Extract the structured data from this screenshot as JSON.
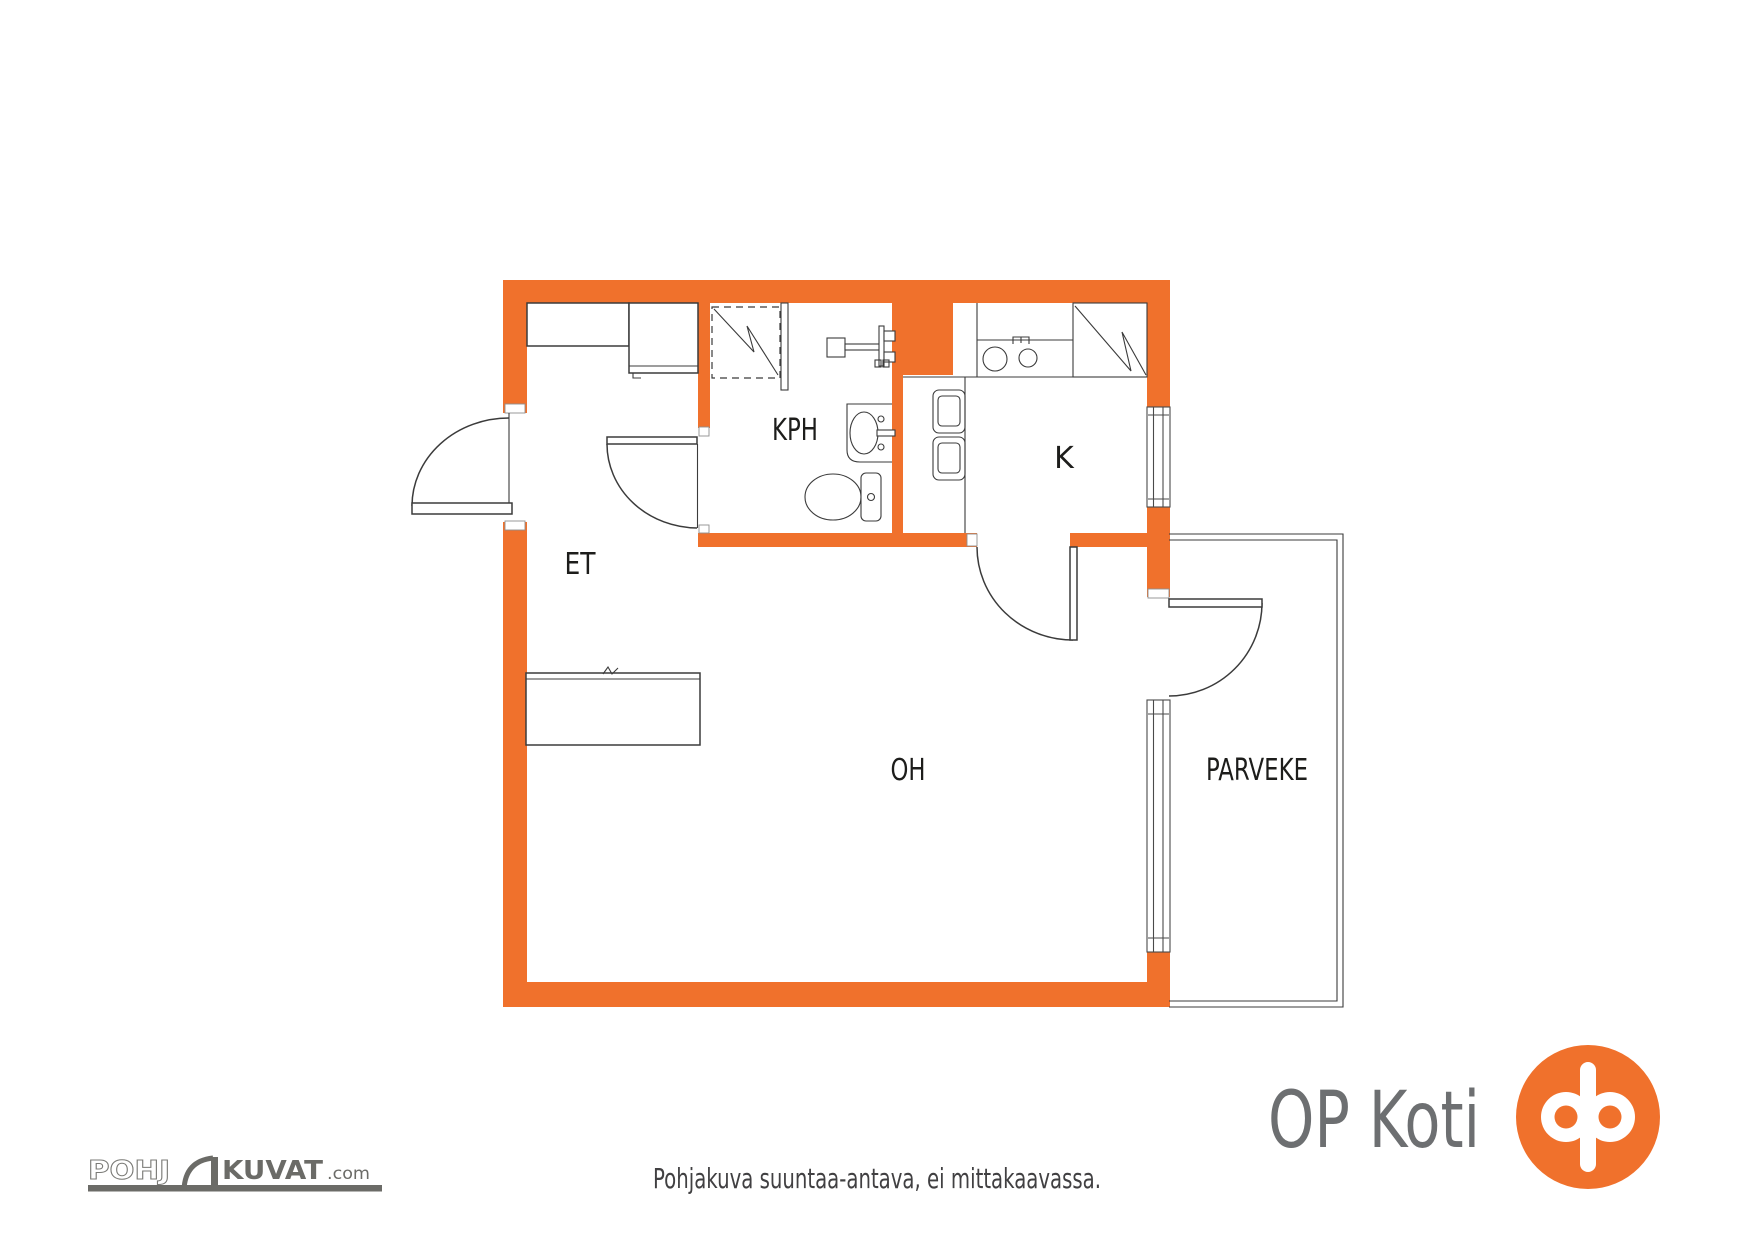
{
  "floor_plan": {
    "rooms": [
      {
        "id": "et",
        "label": "ET"
      },
      {
        "id": "kph",
        "label": "KPH"
      },
      {
        "id": "k",
        "label": "K"
      },
      {
        "id": "oh",
        "label": "OH"
      },
      {
        "id": "parveke",
        "label": "PARVEKE"
      }
    ],
    "disclaimer": "Pohjakuva suuntaa-antava, ei mittakaavassa."
  },
  "branding": {
    "op_koti_text": "OP Koti",
    "pohjakuvat": {
      "left": "POHJ",
      "right": "KUVAT",
      "tld": ".com"
    }
  },
  "colors": {
    "wall_orange": "#F0712C",
    "plan_line": "#3B3B3B",
    "label_color": "#1D1D1B",
    "logo_gray": "#6D6F71",
    "disclaimer_color": "#414042"
  }
}
